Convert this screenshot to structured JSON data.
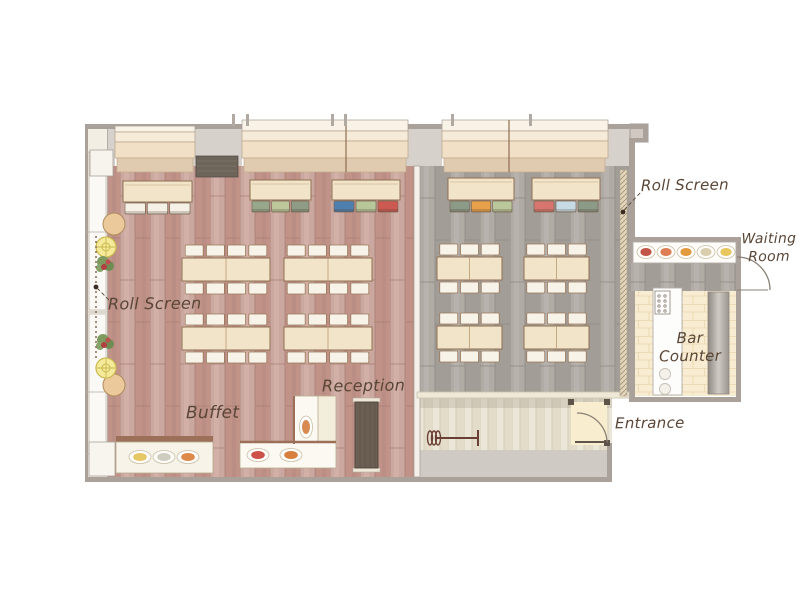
{
  "plan": {
    "title": "Restaurant floor plan",
    "labels": {
      "roll_screen_left": "Roll Screen",
      "roll_screen_right": "Roll Screen",
      "waiting_room": "Waiting Room",
      "bar_counter": "Bar Counter",
      "entrance": "Entrance",
      "reception": "Reception",
      "buffet": "Buffet"
    },
    "areas": [
      "main-dining-room",
      "second-dining-room",
      "corridor",
      "entrance",
      "waiting-room",
      "bar-counter",
      "buffet",
      "reception"
    ],
    "palette": {
      "floor_main_dining": "#cba89f",
      "floor_second_dining": "#aba6a0",
      "floor_corridor": "#ebe6d7",
      "floor_bar_tile": "#f8ecd2",
      "floor_entrance": "#f8eecf",
      "wall": "#a9a19a",
      "exterior": "#d6d1cb",
      "furniture_wood": "#f2e4c9",
      "label_ink": "#5a4636"
    },
    "banquette_tables": [
      {
        "chairs": [
          "#f6f1e6",
          "#f6f1e6",
          "#f6f1e6"
        ]
      },
      {
        "chairs": [
          "#97a78c",
          "#bcc89c",
          "#8e9c86"
        ]
      },
      {
        "chairs": [
          "#4f7fae",
          "#b7c79a",
          "#cc5a52"
        ]
      },
      {
        "chairs": [
          "#8c9a88",
          "#e8a04b",
          "#b9c79b"
        ]
      },
      {
        "chairs": [
          "#d6766f",
          "#c7dbe5",
          "#8c9a88"
        ]
      }
    ],
    "dining_groups": {
      "left_room": {
        "count": 4,
        "seats_per_group": 8
      },
      "right_room": {
        "count": 4,
        "seats_per_group": 6
      }
    },
    "display_dishes": [
      "#c05548",
      "#dd7f52",
      "#e29a3e",
      "#d9cfae",
      "#e8c75e"
    ],
    "buffet_dishes_left": [
      "#e6c766",
      "#cfcdc0",
      "#dd8a4a"
    ],
    "buffet_dishes_right": [
      "#cc5148",
      "#d87f3e",
      "#d98a52"
    ]
  }
}
